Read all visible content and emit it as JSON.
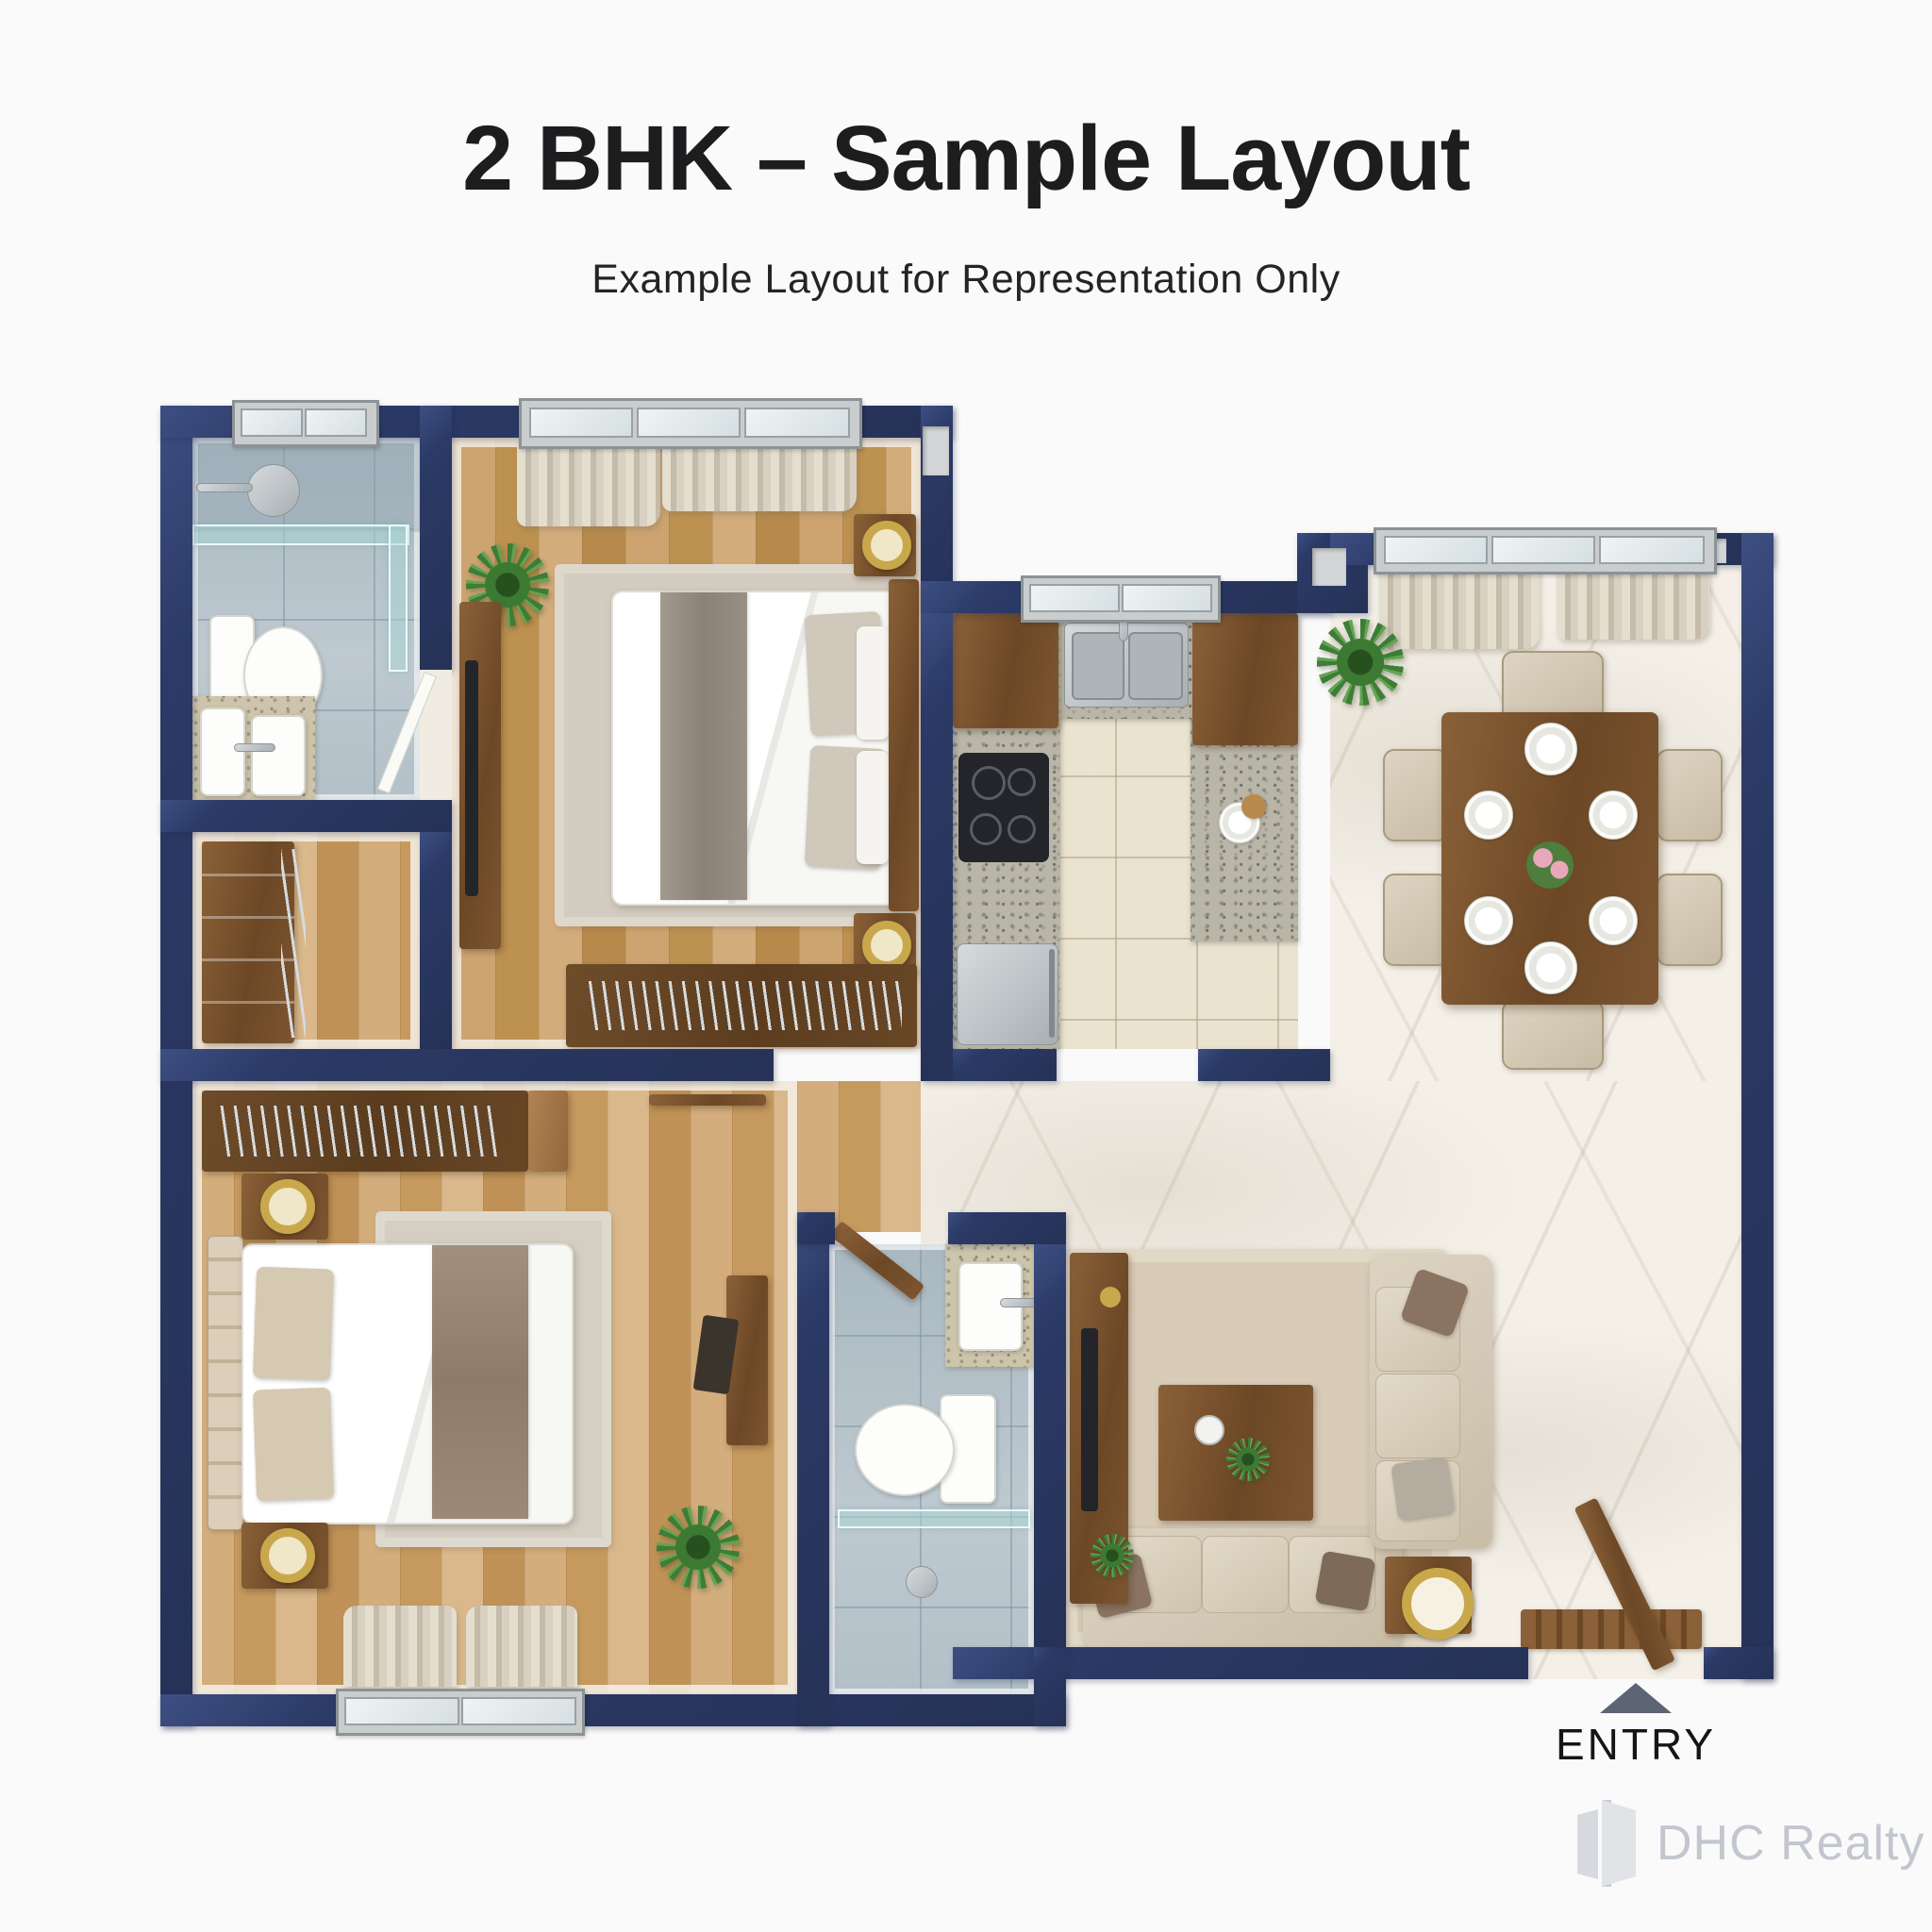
{
  "header": {
    "title": "2 BHK – Sample Layout",
    "subtitle": "Example Layout for Representation Only"
  },
  "entry": {
    "label": "ENTRY"
  },
  "watermark": {
    "brand": "DHC Realty"
  },
  "palette": {
    "wall": "#2b3a66",
    "gold": "#c9a84c",
    "marble": "#f4f0e8",
    "wood_floor_1": "#c89a5f",
    "wood_floor_2": "#cfa878",
    "bath_tile": "#b7c3cb",
    "kitchen_tile": "#eae3d0",
    "granite": "#b9b5a7",
    "sofa": "#d9cfbf",
    "title_text": "#1d1d1f",
    "subtitle_text": "#242426",
    "entry_text": "#151515",
    "watermark_text": "#c2c6cf"
  }
}
